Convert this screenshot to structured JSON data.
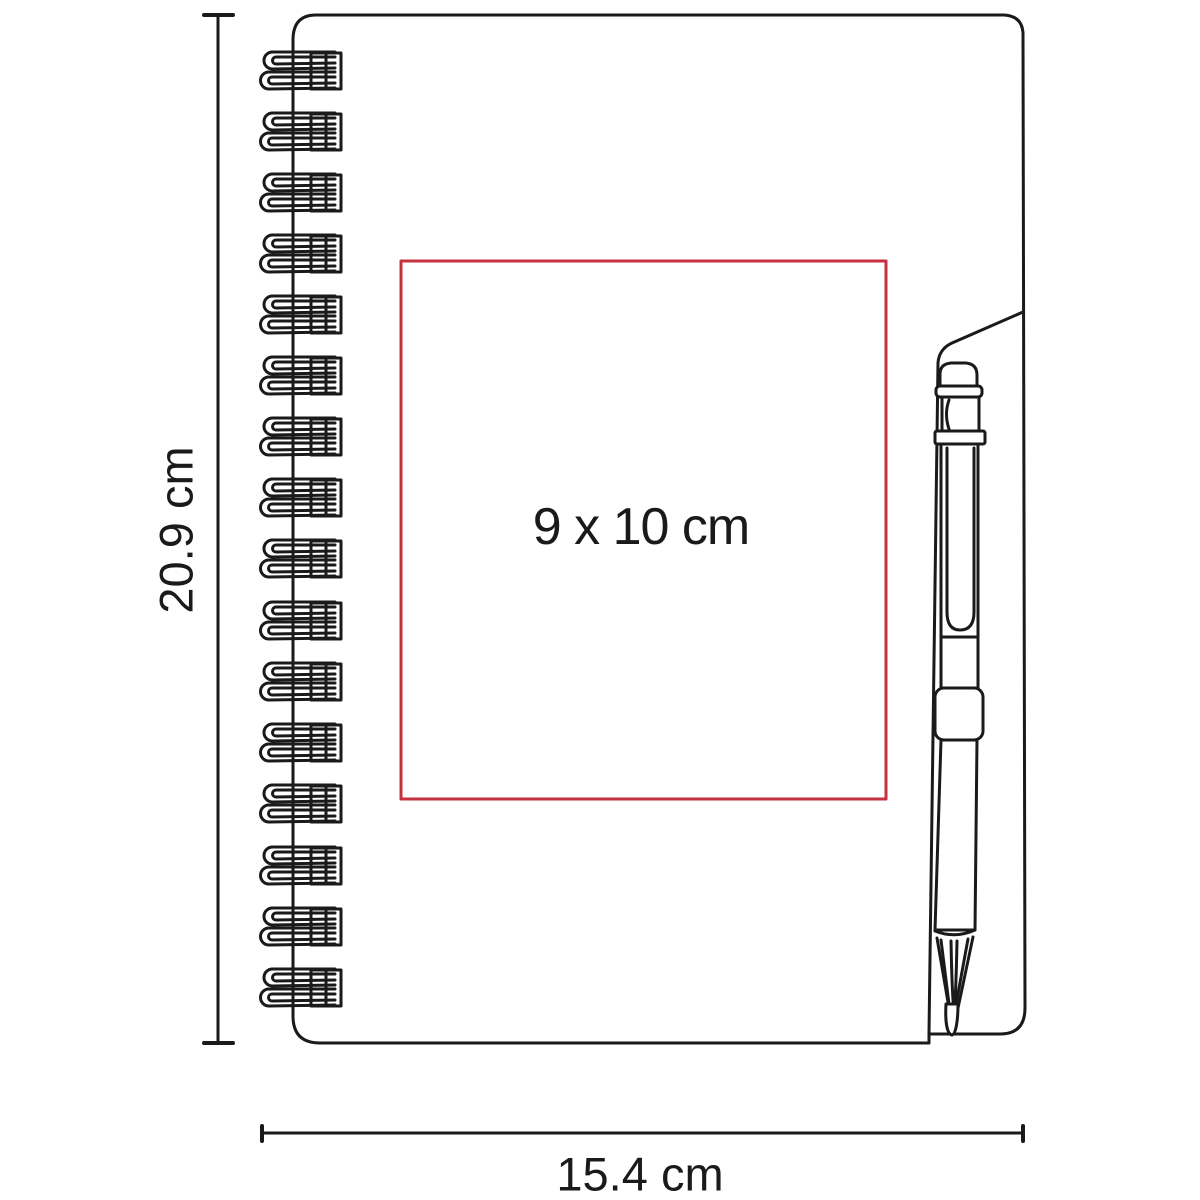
{
  "figure": {
    "type": "product-dimension-diagram",
    "subject": "spiral-notebook-with-pen"
  },
  "dimensions": {
    "height_label": "20.9 cm",
    "width_label": "15.4 cm"
  },
  "print_area": {
    "label": "9 x 10 cm"
  },
  "colors": {
    "outline": "#1a1a1a",
    "print_area_red": "#c5313f",
    "background": "#ffffff"
  }
}
